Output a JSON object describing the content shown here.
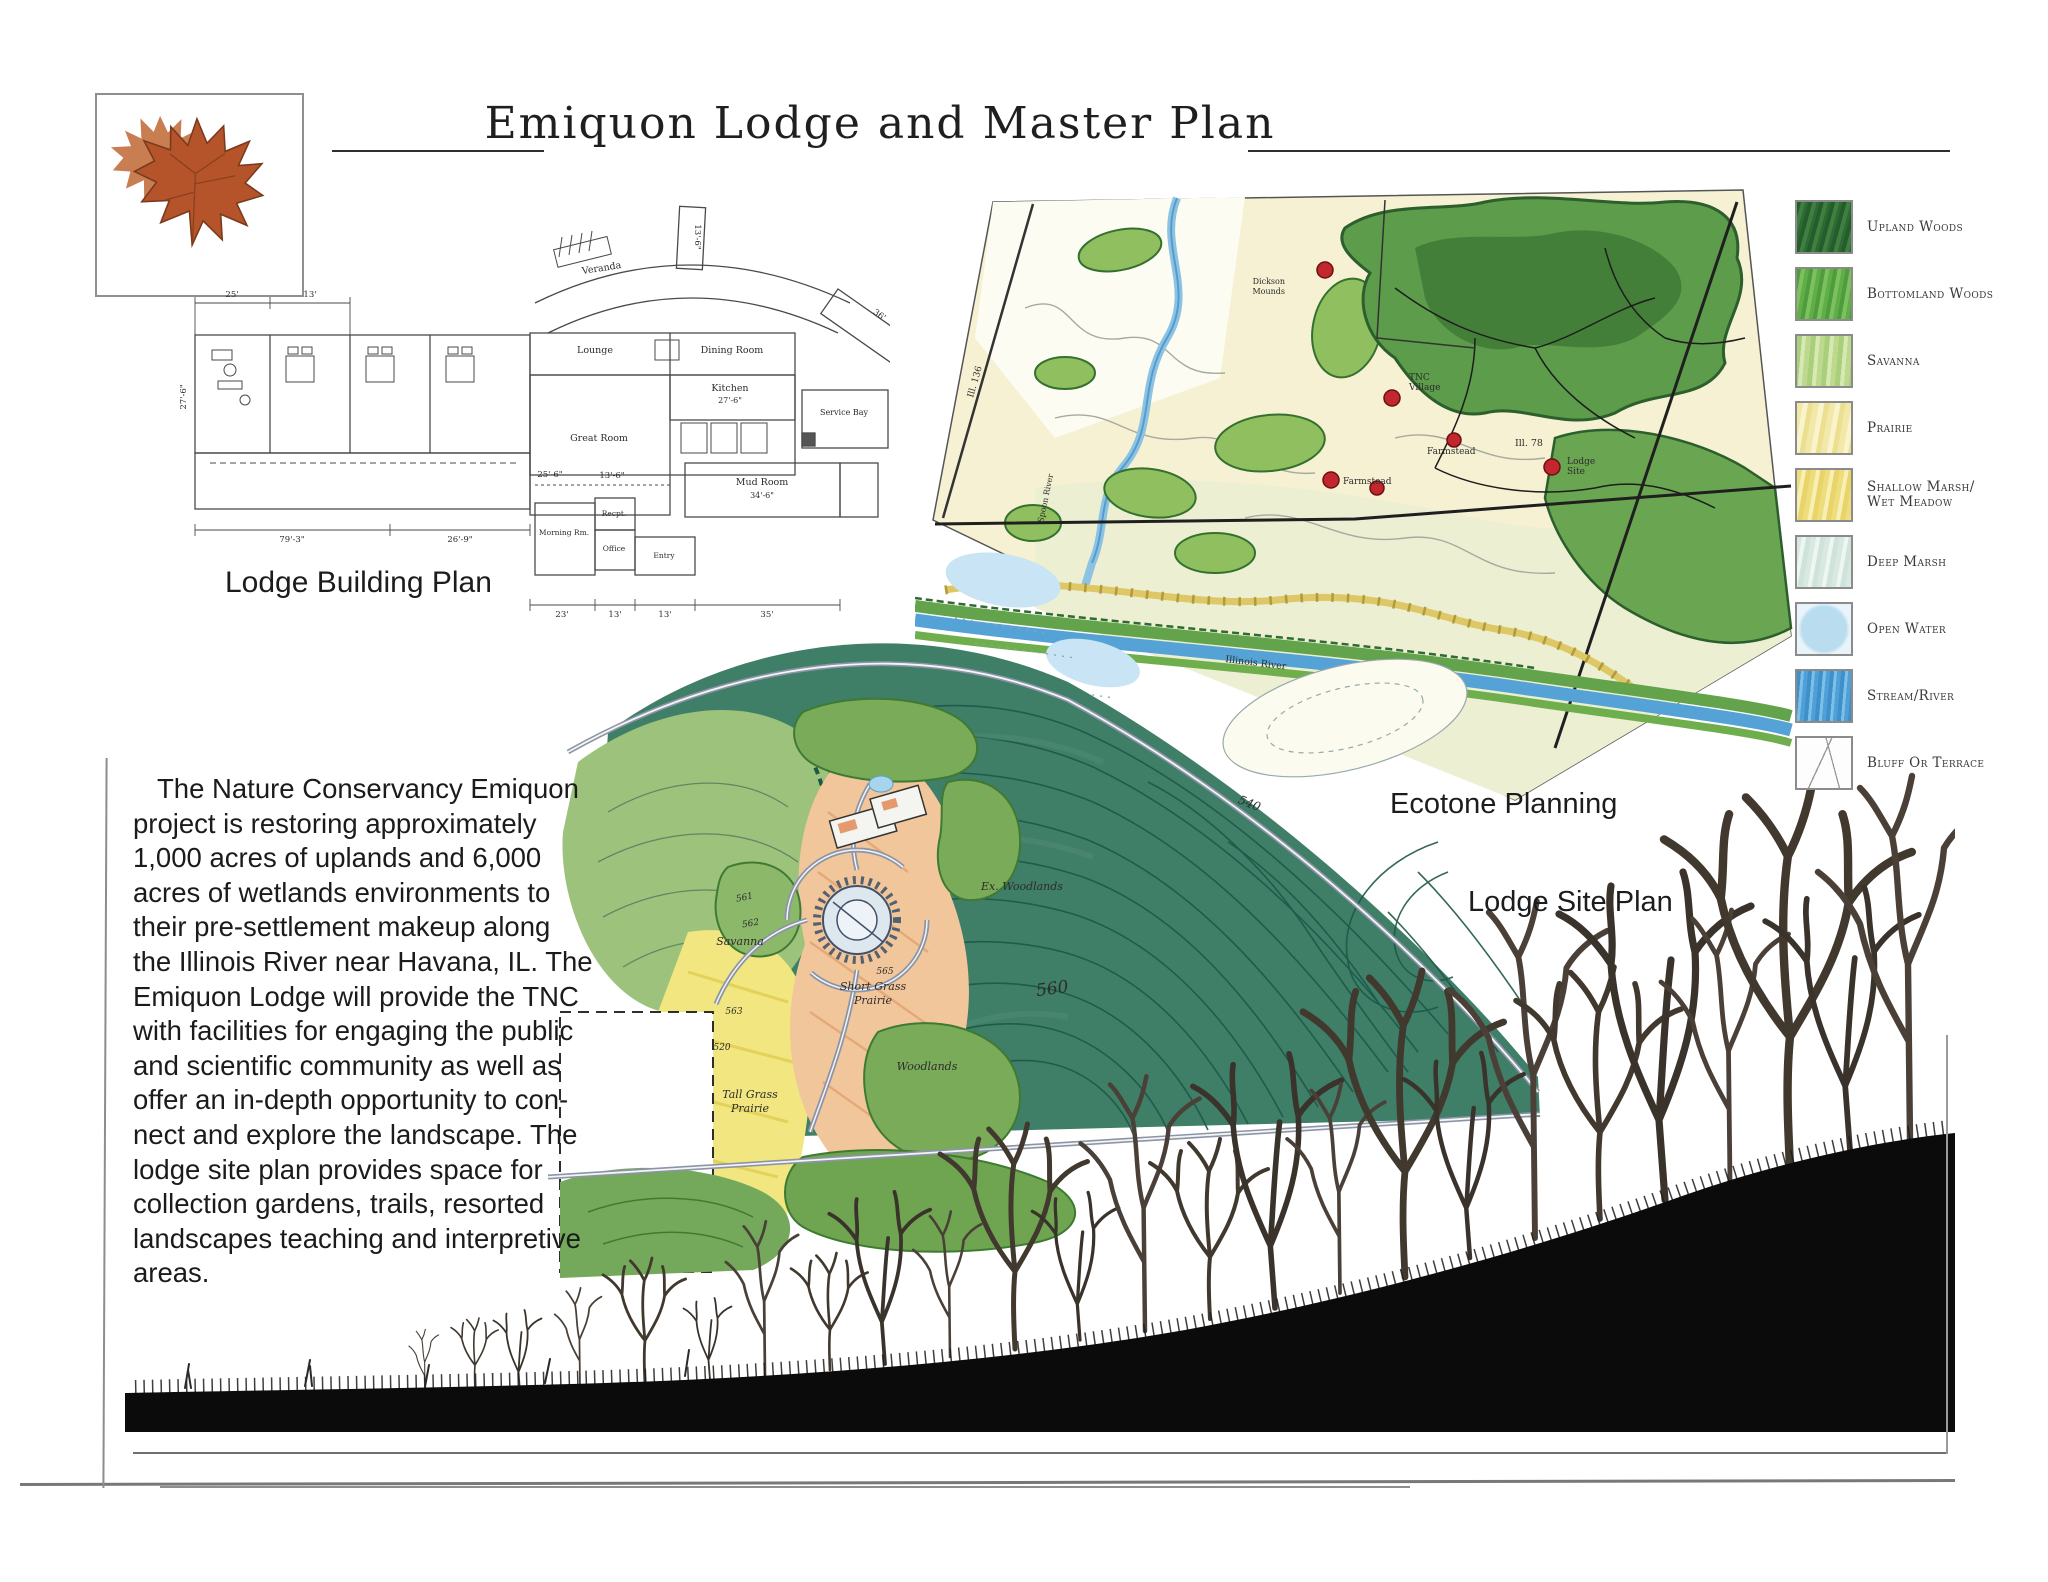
{
  "page": {
    "title": "Emiquon Lodge and Master Plan"
  },
  "captions": {
    "building_plan": "Lodge Building Plan",
    "ecotone": "Ecotone Planning",
    "site_plan": "Lodge Site Plan"
  },
  "description": "The Nature Conservancy Emiquon\nproject is restoring approximately\n1,000 acres of uplands and 6,000\nacres of wetlands environments to\ntheir pre-settlement makeup along\nthe Illinois River near Havana, IL. The\nEmiquon Lodge will provide the TNC\nwith facilities for engaging the public\nand scientific community as well as\noffer an in-depth opportunity to con-\nnect and explore the landscape. The\nlodge site plan provides space for\ncollection gardens, trails, resorted\nlandscapes teaching and interpretive\nareas.",
  "legend": {
    "items": [
      {
        "label": "Upland Woods",
        "color": "#2e6b34"
      },
      {
        "label": "Bottomland Woods",
        "color": "#5fae46"
      },
      {
        "label": "Savanna",
        "color": "#a9cf7a"
      },
      {
        "label": "Prairie",
        "color": "#f2e9a8"
      },
      {
        "label": "Shallow Marsh/\nWet Meadow",
        "color": "#eedd7d"
      },
      {
        "label": "Deep Marsh",
        "color": "#d9e9e2"
      },
      {
        "label": "Open Water",
        "color": "#b9dcef"
      },
      {
        "label": "Stream/River",
        "color": "#4f9fd8"
      },
      {
        "label": "Bluff Or Terrace",
        "color": "#ffffff"
      }
    ]
  },
  "building_plan": {
    "rooms": {
      "veranda": "Veranda",
      "lounge": "Lounge",
      "dining": "Dining Room",
      "kitchen": "Kitchen",
      "kitchen_dim": "27'-6\"",
      "great": "Great Room",
      "service": "Service Bay",
      "mud": "Mud Room",
      "mud_dim": "34'-6\"",
      "morning": "Morning Rm.",
      "recpt": "Recpt.",
      "office": "Office",
      "entry": "Entry"
    },
    "dims": {
      "w25": "25'",
      "w13": "13'",
      "v36": "36'",
      "t136": "13'-6\"",
      "s256": "25'-6\"",
      "s136": "13'-6\"",
      "s269": "26'-9\"",
      "s793": "79'-3\"",
      "side276": "27'-6\"",
      "b23": "23'",
      "b13a": "13'",
      "b13b": "13'",
      "b35": "35'"
    }
  },
  "ecotone": {
    "labels": {
      "ill136": "Ill. 136",
      "spoon": "Spoon River",
      "dickson1": "Dickson",
      "dickson2": "Mounds",
      "tnc1": "TNC",
      "tnc2": "Village",
      "farm1": "Farmstead",
      "ill78": "Ill. 78",
      "lodge1": "Lodge",
      "lodge2": "Site",
      "farm2": "Farmstead",
      "river": "Illinois River"
    }
  },
  "site_plan": {
    "labels": {
      "ex_woodlands": "Ex. Woodlands",
      "short1": "Short Grass",
      "short2": "Prairie",
      "tall1": "Tall Grass",
      "tall2": "Prairie",
      "woodlands": "Woodlands",
      "savanna": "Savanna",
      "c561": "561",
      "c562": "562",
      "c563": "563",
      "c565": "565",
      "c560": "560",
      "c520": "520",
      "c540": "540"
    }
  }
}
